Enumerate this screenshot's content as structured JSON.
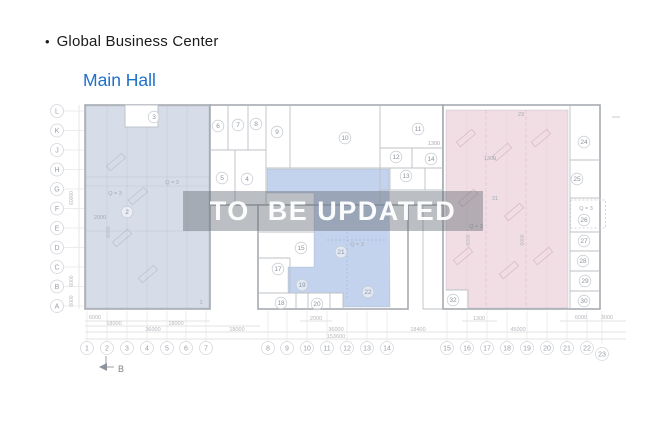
{
  "header": {
    "bullet": "•",
    "title": "Global Business Center",
    "subtitle": "Main Hall",
    "title_color": "#1b1b1d",
    "subtitle_color": "#1d70cd"
  },
  "watermark": {
    "text": "TO  BE UPDATED",
    "band_color": "rgba(104,110,120,0.45)",
    "text_color": "rgba(255,255,255,0.95)"
  },
  "plan": {
    "colors": {
      "zone_left": "rgba(163,180,203,0.45)",
      "zone_center": "rgba(136,167,219,0.50)",
      "zone_right": "rgba(214,154,172,0.33)",
      "wall": "#a7abb1",
      "inner_wall": "#bcc0c6",
      "grid_label": "#9aa0a8",
      "room_label": "#8d939b",
      "dim_label": "#b4b8be"
    },
    "grid_rows": [
      "L",
      "K",
      "J",
      "H",
      "G",
      "F",
      "E",
      "D",
      "C",
      "B",
      "A"
    ],
    "grid_columns": [
      {
        "t": "1",
        "x": 87
      },
      {
        "t": "2",
        "x": 107
      },
      {
        "t": "3",
        "x": 127
      },
      {
        "t": "4",
        "x": 147
      },
      {
        "t": "5",
        "x": 167
      },
      {
        "t": "6",
        "x": 186
      },
      {
        "t": "7",
        "x": 206
      },
      {
        "t": "8",
        "x": 268
      },
      {
        "t": "9",
        "x": 287
      },
      {
        "t": "10",
        "x": 307
      },
      {
        "t": "11",
        "x": 327
      },
      {
        "t": "12",
        "x": 347
      },
      {
        "t": "13",
        "x": 367
      },
      {
        "t": "14",
        "x": 387
      },
      {
        "t": "15",
        "x": 447
      },
      {
        "t": "16",
        "x": 467
      },
      {
        "t": "17",
        "x": 487
      },
      {
        "t": "18",
        "x": 507
      },
      {
        "t": "19",
        "x": 527
      },
      {
        "t": "20",
        "x": 547
      },
      {
        "t": "21",
        "x": 567
      },
      {
        "t": "22",
        "x": 587
      },
      {
        "t": "23",
        "x": 602,
        "y": 354
      }
    ],
    "room_labels": [
      {
        "t": "3",
        "x": 154,
        "y": 117
      },
      {
        "t": "2",
        "x": 127,
        "y": 212
      },
      {
        "t": "6",
        "x": 218,
        "y": 126
      },
      {
        "t": "7",
        "x": 238,
        "y": 125
      },
      {
        "t": "8",
        "x": 256,
        "y": 124
      },
      {
        "t": "5",
        "x": 222,
        "y": 178
      },
      {
        "t": "4",
        "x": 247,
        "y": 179
      },
      {
        "t": "9",
        "x": 277,
        "y": 132
      },
      {
        "t": "10",
        "x": 345,
        "y": 138
      },
      {
        "t": "11",
        "x": 418,
        "y": 129
      },
      {
        "t": "12",
        "x": 396,
        "y": 157
      },
      {
        "t": "14",
        "x": 431,
        "y": 159
      },
      {
        "t": "13",
        "x": 406,
        "y": 176
      },
      {
        "t": "15",
        "x": 301,
        "y": 248
      },
      {
        "t": "17",
        "x": 278,
        "y": 269
      },
      {
        "t": "18",
        "x": 281,
        "y": 303
      },
      {
        "t": "19",
        "x": 302,
        "y": 285
      },
      {
        "t": "20",
        "x": 317,
        "y": 304
      },
      {
        "t": "21",
        "x": 341,
        "y": 252
      },
      {
        "t": "22",
        "x": 368,
        "y": 292
      },
      {
        "t": "24",
        "x": 584,
        "y": 142
      },
      {
        "t": "25",
        "x": 577,
        "y": 179
      },
      {
        "t": "26",
        "x": 584,
        "y": 220
      },
      {
        "t": "27",
        "x": 584,
        "y": 241
      },
      {
        "t": "28",
        "x": 583,
        "y": 261
      },
      {
        "t": "29",
        "x": 585,
        "y": 281
      },
      {
        "t": "30",
        "x": 584,
        "y": 301
      },
      {
        "t": "32",
        "x": 453,
        "y": 300
      }
    ],
    "plain_labels": [
      {
        "t": "23",
        "x": 521,
        "y": 116
      },
      {
        "t": "31",
        "x": 495,
        "y": 200
      },
      {
        "t": "1",
        "x": 201,
        "y": 304
      },
      {
        "t": "Q = 3",
        "x": 115,
        "y": 195
      },
      {
        "t": "Q = 3",
        "x": 172,
        "y": 184
      },
      {
        "t": "2000",
        "x": 100,
        "y": 219
      },
      {
        "t": "Q = 3",
        "x": 357,
        "y": 246
      },
      {
        "t": "Q = 3",
        "x": 476,
        "y": 228
      },
      {
        "t": "Q = 3",
        "x": 586,
        "y": 210
      },
      {
        "t": "1300",
        "x": 434,
        "y": 145
      },
      {
        "t": "1300",
        "x": 490,
        "y": 160
      }
    ],
    "rotated_labels": [
      {
        "t": "60000",
        "x": 73,
        "y": 198
      },
      {
        "t": "6000",
        "x": 73,
        "y": 281
      },
      {
        "t": "6000",
        "x": 73,
        "y": 301
      },
      {
        "t": "6000",
        "x": 110,
        "y": 232
      },
      {
        "t": "6000",
        "x": 470,
        "y": 240
      },
      {
        "t": "6000",
        "x": 524,
        "y": 240
      }
    ],
    "dim_labels": [
      {
        "t": "6000",
        "x": 95,
        "y": 319
      },
      {
        "t": "18000",
        "x": 114,
        "y": 325
      },
      {
        "t": "18000",
        "x": 176,
        "y": 325
      },
      {
        "t": "36000",
        "x": 153,
        "y": 331
      },
      {
        "t": "18000",
        "x": 237,
        "y": 331
      },
      {
        "t": "2000",
        "x": 316,
        "y": 320
      },
      {
        "t": "36000",
        "x": 336,
        "y": 331
      },
      {
        "t": "153600",
        "x": 336,
        "y": 338
      },
      {
        "t": "18400",
        "x": 418,
        "y": 331
      },
      {
        "t": "1300",
        "x": 479,
        "y": 320
      },
      {
        "t": "45000",
        "x": 518,
        "y": 331
      },
      {
        "t": "6000",
        "x": 581,
        "y": 319
      },
      {
        "t": "3000",
        "x": 607,
        "y": 319
      }
    ],
    "section_marker": "B"
  }
}
